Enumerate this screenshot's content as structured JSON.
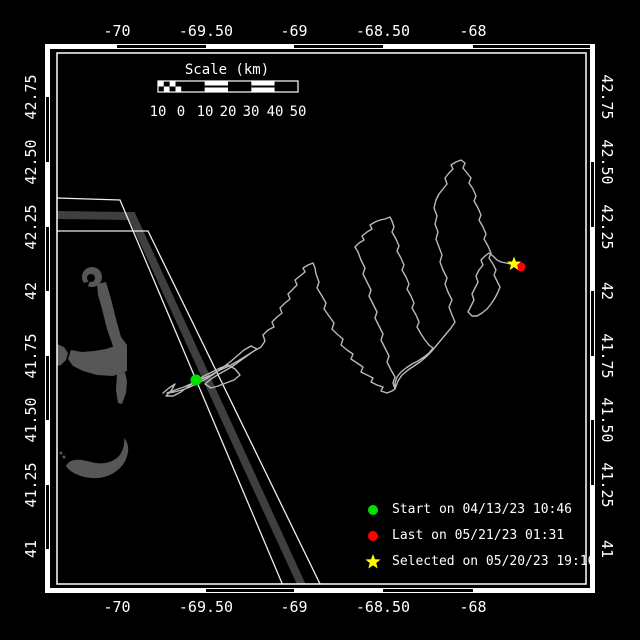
{
  "colors": {
    "background": "#000000",
    "frame": "#ffffff",
    "text": "#ffffff"
  },
  "frame": {
    "inner_rect": [
      57,
      53,
      529,
      531
    ],
    "outer": {
      "x": 45,
      "y": 44,
      "w": 550,
      "h": 549,
      "t": 5
    },
    "black_segments": {
      "top": [
        [
          117,
          206
        ],
        [
          294,
          383
        ],
        [
          473,
          590
        ]
      ],
      "bottom": [
        [
          206,
          294
        ],
        [
          383,
          473
        ]
      ],
      "left": [
        [
          97,
          162
        ],
        [
          227,
          291
        ],
        [
          356,
          420
        ],
        [
          485,
          549
        ]
      ],
      "right": [
        [
          162,
          227
        ],
        [
          291,
          356
        ],
        [
          420,
          485
        ]
      ]
    }
  },
  "axes": {
    "top": {
      "y": 31,
      "ticks": [
        {
          "label": "-70",
          "x": 117
        },
        {
          "label": "-69.50",
          "x": 206
        },
        {
          "label": "-69",
          "x": 294
        },
        {
          "label": "-68.50",
          "x": 383
        },
        {
          "label": "-68",
          "x": 473
        }
      ]
    },
    "bottom": {
      "y": 607,
      "ticks": [
        {
          "label": "-70",
          "x": 117
        },
        {
          "label": "-69.50",
          "x": 206
        },
        {
          "label": "-69",
          "x": 294
        },
        {
          "label": "-68.50",
          "x": 383
        },
        {
          "label": "-68",
          "x": 473
        }
      ]
    },
    "left": {
      "x": 31,
      "ticks": [
        {
          "label": "42.75",
          "y": 97
        },
        {
          "label": "42.50",
          "y": 162
        },
        {
          "label": "42.25",
          "y": 227
        },
        {
          "label": "42",
          "y": 291
        },
        {
          "label": "41.75",
          "y": 356
        },
        {
          "label": "41.50",
          "y": 420
        },
        {
          "label": "41.25",
          "y": 485
        },
        {
          "label": "41",
          "y": 549
        }
      ]
    },
    "right": {
      "x": 607,
      "ticks": [
        {
          "label": "42.75",
          "y": 97
        },
        {
          "label": "42.50",
          "y": 162
        },
        {
          "label": "42.25",
          "y": 227
        },
        {
          "label": "42",
          "y": 291
        },
        {
          "label": "41.75",
          "y": 356
        },
        {
          "label": "41.50",
          "y": 420
        },
        {
          "label": "41.25",
          "y": 485
        },
        {
          "label": "41",
          "y": 549
        }
      ]
    }
  },
  "scalebar": {
    "title": "Scale (km)",
    "title_x": 227,
    "title_y": 70,
    "bar": {
      "x": 158,
      "y": 81,
      "w": 140,
      "h": 11
    },
    "label_y": 112,
    "labels": [
      {
        "t": "10",
        "x": 158
      },
      {
        "t": "0",
        "x": 181
      },
      {
        "t": "10",
        "x": 205
      },
      {
        "t": "20",
        "x": 228
      },
      {
        "t": "30",
        "x": 251
      },
      {
        "t": "40",
        "x": 275
      },
      {
        "t": "50",
        "x": 298
      }
    ]
  },
  "land": {
    "color": "#575757",
    "shapes": [
      {
        "type": "circle",
        "cx": 92,
        "cy": 277,
        "r": 10
      },
      {
        "type": "circle",
        "cx": 91,
        "cy": 278,
        "r": 4,
        "fill": "#000000"
      },
      {
        "type": "path",
        "d": "M78,285 L90,281 L85,293 Z",
        "fill": "#000000"
      },
      {
        "type": "path",
        "d": "M97,284 L106,282 L111,299 L116,319 L121,337 L127,345 L126,353 L114,349 L107,329 L102,309 L98,295 Z"
      },
      {
        "type": "path",
        "d": "M71,350 L82,352 L94,351 L106,349 L118,345 L127,347 L127,371 L113,376 L97,375 L83,371 L73,366 L68,359 Z"
      },
      {
        "type": "path",
        "d": "M117,374 L125,372 L127,381 L126,393 L122,404 L118,403 L116,390 Z"
      },
      {
        "type": "path",
        "d": "M57,344 L64,347 L68,353 L66,360 L61,365 L57,366 Z"
      },
      {
        "type": "path",
        "d": "M66,466 C70,458 80,459 91,462 C102,465 112,463 119,456 C123,451 125,444 124,438 C128,442 130,450 126,459 C122,469 111,477 98,478 C85,479 71,474 66,466 Z"
      },
      {
        "type": "circle",
        "cx": 61,
        "cy": 453,
        "r": 1.5
      },
      {
        "type": "circle",
        "cx": 64,
        "cy": 457,
        "r": 1.5
      }
    ]
  },
  "lanes": {
    "stripe": {
      "color": "#3f3f3f",
      "width": 8,
      "points": [
        [
          57,
          215
        ],
        [
          132,
          216
        ],
        [
          303,
          588
        ]
      ]
    },
    "lines": {
      "color": "#ededed",
      "width": 1.3,
      "paths": [
        [
          [
            57,
            198
          ],
          [
            120,
            200
          ],
          [
            284,
            588
          ]
        ],
        [
          [
            57,
            231
          ],
          [
            148,
            231
          ],
          [
            322,
            588
          ]
        ]
      ]
    }
  },
  "track": {
    "color": "#b9b9b9",
    "width": 1.4,
    "points": [
      [
        163,
        393
      ],
      [
        169,
        388
      ],
      [
        175,
        384
      ],
      [
        171,
        391
      ],
      [
        166,
        396
      ],
      [
        173,
        396
      ],
      [
        181,
        392
      ],
      [
        189,
        386
      ],
      [
        196,
        381
      ],
      [
        204,
        376
      ],
      [
        212,
        372
      ],
      [
        220,
        368
      ],
      [
        228,
        365
      ],
      [
        235,
        369
      ],
      [
        240,
        375
      ],
      [
        234,
        380
      ],
      [
        226,
        383
      ],
      [
        218,
        386
      ],
      [
        211,
        388
      ],
      [
        205,
        384
      ],
      [
        211,
        379
      ],
      [
        219,
        374
      ],
      [
        228,
        369
      ],
      [
        236,
        364
      ],
      [
        244,
        358
      ],
      [
        251,
        353
      ],
      [
        257,
        349
      ],
      [
        251,
        346
      ],
      [
        244,
        350
      ],
      [
        237,
        356
      ],
      [
        230,
        362
      ],
      [
        222,
        368
      ],
      [
        214,
        374
      ],
      [
        206,
        379
      ],
      [
        198,
        383
      ],
      [
        190,
        387
      ],
      [
        182,
        390
      ],
      [
        174,
        392
      ],
      [
        167,
        393
      ],
      [
        175,
        390
      ],
      [
        184,
        387
      ],
      [
        193,
        383
      ],
      [
        202,
        379
      ],
      [
        211,
        375
      ],
      [
        220,
        370
      ],
      [
        229,
        366
      ],
      [
        238,
        361
      ],
      [
        246,
        356
      ],
      [
        254,
        351
      ],
      [
        261,
        347
      ],
      [
        265,
        341
      ],
      [
        263,
        335
      ],
      [
        268,
        330
      ],
      [
        274,
        327
      ],
      [
        272,
        322
      ],
      [
        277,
        317
      ],
      [
        282,
        313
      ],
      [
        280,
        308
      ],
      [
        285,
        303
      ],
      [
        290,
        299
      ],
      [
        288,
        294
      ],
      [
        293,
        289
      ],
      [
        297,
        285
      ],
      [
        295,
        280
      ],
      [
        300,
        276
      ],
      [
        305,
        272
      ],
      [
        303,
        268
      ],
      [
        308,
        265
      ],
      [
        313,
        263
      ],
      [
        315,
        268
      ],
      [
        316,
        274
      ],
      [
        319,
        282
      ],
      [
        317,
        288
      ],
      [
        322,
        296
      ],
      [
        326,
        303
      ],
      [
        324,
        309
      ],
      [
        329,
        316
      ],
      [
        334,
        323
      ],
      [
        332,
        329
      ],
      [
        337,
        334
      ],
      [
        343,
        339
      ],
      [
        341,
        345
      ],
      [
        347,
        350
      ],
      [
        353,
        354
      ],
      [
        351,
        359
      ],
      [
        357,
        363
      ],
      [
        363,
        367
      ],
      [
        361,
        372
      ],
      [
        367,
        375
      ],
      [
        373,
        378
      ],
      [
        371,
        382
      ],
      [
        377,
        385
      ],
      [
        383,
        387
      ],
      [
        381,
        391
      ],
      [
        387,
        393
      ],
      [
        392,
        391
      ],
      [
        395,
        389
      ],
      [
        393,
        383
      ],
      [
        395,
        377
      ],
      [
        391,
        370
      ],
      [
        387,
        362
      ],
      [
        389,
        356
      ],
      [
        385,
        348
      ],
      [
        381,
        340
      ],
      [
        383,
        334
      ],
      [
        379,
        326
      ],
      [
        375,
        318
      ],
      [
        377,
        312
      ],
      [
        373,
        304
      ],
      [
        369,
        296
      ],
      [
        371,
        290
      ],
      [
        367,
        282
      ],
      [
        363,
        274
      ],
      [
        365,
        268
      ],
      [
        361,
        260
      ],
      [
        358,
        252
      ],
      [
        355,
        247
      ],
      [
        359,
        243
      ],
      [
        364,
        240
      ],
      [
        362,
        236
      ],
      [
        367,
        232
      ],
      [
        372,
        229
      ],
      [
        370,
        225
      ],
      [
        375,
        222
      ],
      [
        380,
        220
      ],
      [
        385,
        219
      ],
      [
        390,
        217
      ],
      [
        392,
        221
      ],
      [
        394,
        227
      ],
      [
        392,
        232
      ],
      [
        396,
        239
      ],
      [
        399,
        246
      ],
      [
        397,
        251
      ],
      [
        401,
        258
      ],
      [
        404,
        265
      ],
      [
        402,
        270
      ],
      [
        406,
        277
      ],
      [
        409,
        284
      ],
      [
        407,
        289
      ],
      [
        411,
        296
      ],
      [
        414,
        303
      ],
      [
        412,
        308
      ],
      [
        416,
        315
      ],
      [
        419,
        322
      ],
      [
        417,
        327
      ],
      [
        421,
        334
      ],
      [
        425,
        340
      ],
      [
        429,
        345
      ],
      [
        433,
        348
      ],
      [
        429,
        353
      ],
      [
        424,
        357
      ],
      [
        418,
        361
      ],
      [
        412,
        364
      ],
      [
        406,
        368
      ],
      [
        401,
        372
      ],
      [
        397,
        377
      ],
      [
        395,
        383
      ],
      [
        395,
        389
      ],
      [
        398,
        381
      ],
      [
        402,
        375
      ],
      [
        408,
        370
      ],
      [
        414,
        366
      ],
      [
        420,
        362
      ],
      [
        426,
        357
      ],
      [
        431,
        352
      ],
      [
        436,
        346
      ],
      [
        441,
        340
      ],
      [
        446,
        334
      ],
      [
        451,
        328
      ],
      [
        455,
        322
      ],
      [
        452,
        315
      ],
      [
        449,
        307
      ],
      [
        452,
        300
      ],
      [
        448,
        292
      ],
      [
        445,
        284
      ],
      [
        447,
        278
      ],
      [
        443,
        270
      ],
      [
        440,
        262
      ],
      [
        442,
        255
      ],
      [
        439,
        247
      ],
      [
        436,
        239
      ],
      [
        438,
        232
      ],
      [
        435,
        224
      ],
      [
        437,
        216
      ],
      [
        434,
        208
      ],
      [
        436,
        200
      ],
      [
        439,
        194
      ],
      [
        443,
        189
      ],
      [
        447,
        184
      ],
      [
        445,
        178
      ],
      [
        449,
        173
      ],
      [
        453,
        169
      ],
      [
        451,
        165
      ],
      [
        456,
        162
      ],
      [
        461,
        160
      ],
      [
        465,
        163
      ],
      [
        463,
        168
      ],
      [
        467,
        173
      ],
      [
        471,
        178
      ],
      [
        469,
        183
      ],
      [
        473,
        189
      ],
      [
        476,
        196
      ],
      [
        474,
        201
      ],
      [
        478,
        208
      ],
      [
        481,
        215
      ],
      [
        479,
        220
      ],
      [
        483,
        227
      ],
      [
        486,
        234
      ],
      [
        484,
        239
      ],
      [
        488,
        246
      ],
      [
        491,
        253
      ],
      [
        489,
        258
      ],
      [
        493,
        264
      ],
      [
        496,
        270
      ],
      [
        494,
        275
      ],
      [
        497,
        281
      ],
      [
        500,
        287
      ],
      [
        498,
        292
      ],
      [
        495,
        298
      ],
      [
        491,
        304
      ],
      [
        487,
        309
      ],
      [
        482,
        313
      ],
      [
        477,
        316
      ],
      [
        472,
        316
      ],
      [
        468,
        312
      ],
      [
        471,
        306
      ],
      [
        474,
        300
      ],
      [
        472,
        294
      ],
      [
        475,
        288
      ],
      [
        478,
        282
      ],
      [
        476,
        276
      ],
      [
        479,
        270
      ],
      [
        483,
        265
      ],
      [
        481,
        260
      ],
      [
        485,
        256
      ],
      [
        489,
        253
      ],
      [
        493,
        256
      ],
      [
        497,
        260
      ],
      [
        501,
        262
      ],
      [
        506,
        263
      ],
      [
        511,
        264
      ],
      [
        514,
        264
      ],
      [
        518,
        266
      ]
    ]
  },
  "markers": {
    "start": {
      "x": 196,
      "y": 380,
      "r": 5.5,
      "color": "#00e100",
      "lon_est": -69.56,
      "lat_est": 41.66
    },
    "last": {
      "x": 521,
      "y": 267,
      "r": 4.5,
      "color": "#ff0000",
      "lon_est": -67.73,
      "lat_est": 42.09
    },
    "selected": {
      "x": 514,
      "y": 264,
      "r": 7.5,
      "color": "#ffff00",
      "lon_est": -67.77,
      "lat_est": 42.1
    }
  },
  "legend": {
    "rows_y": [
      501,
      527,
      553
    ],
    "items": [
      {
        "symbol": "circle",
        "color": "#00e100",
        "label": "Start on 04/13/23 10:46"
      },
      {
        "symbol": "circle",
        "color": "#ff0000",
        "label": "Last on 05/21/23 01:31"
      },
      {
        "symbol": "star",
        "color": "#ffff00",
        "label": "Selected on 05/20/23 19:16"
      }
    ]
  }
}
